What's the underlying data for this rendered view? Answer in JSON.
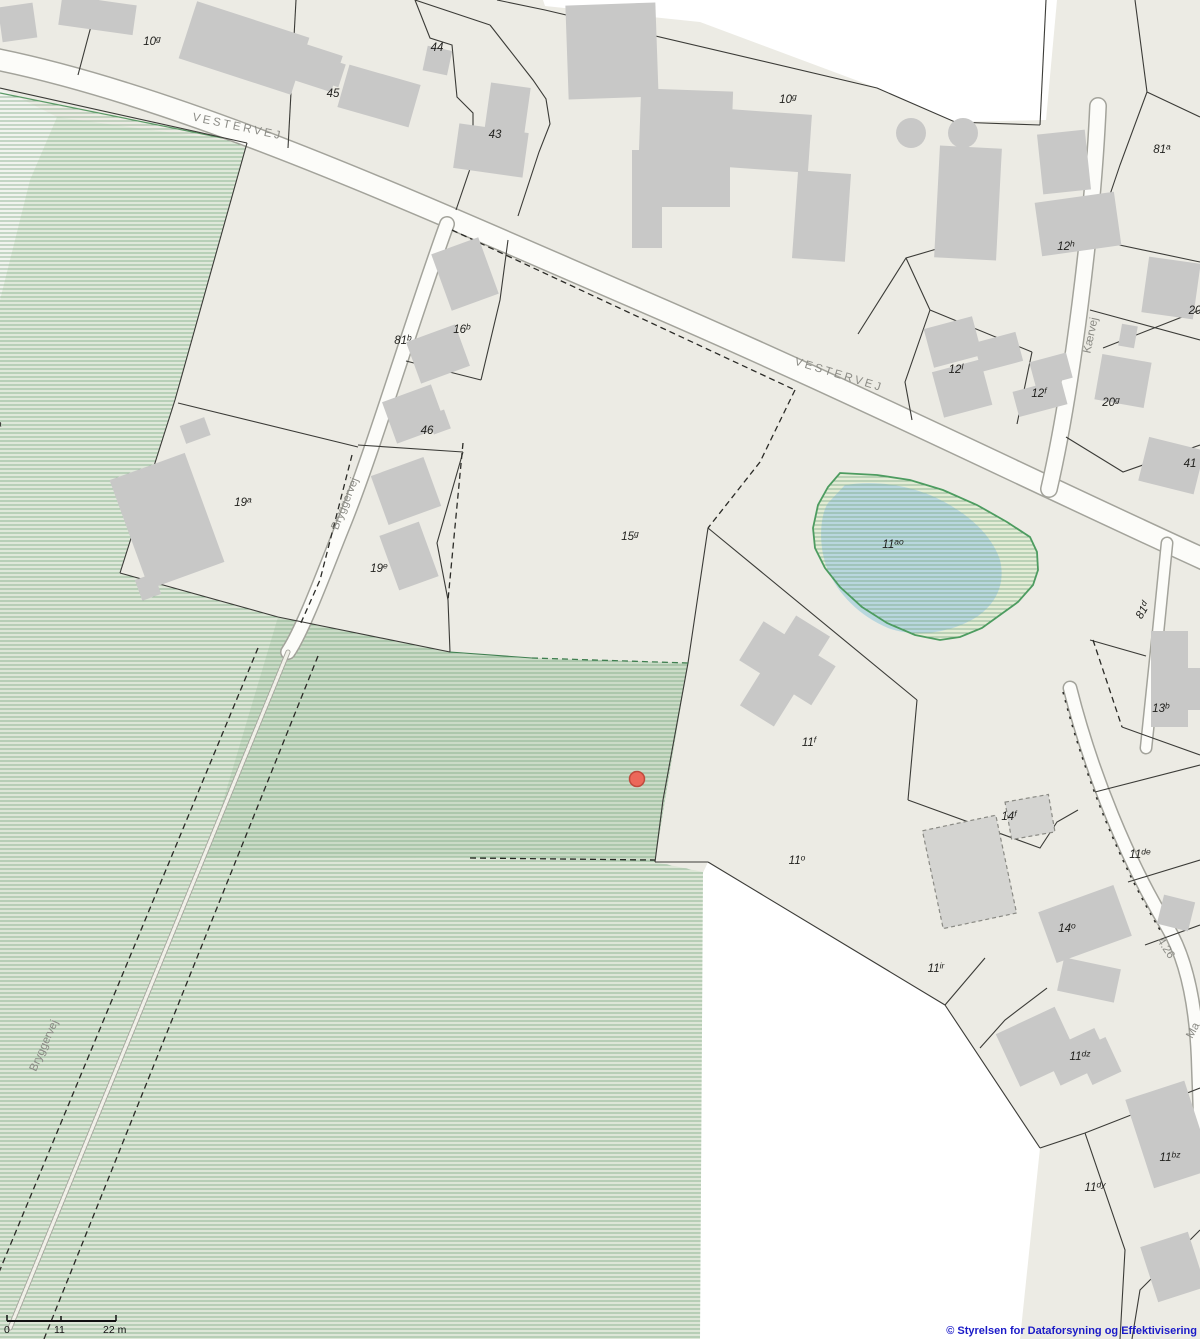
{
  "map": {
    "attribution": "© Styrelsen for Dataforsyning og Effektivisering",
    "scale_bar": {
      "start_label": "0",
      "mid_label": "11",
      "end_label": "22 m"
    },
    "marker": {
      "x": 637,
      "y": 779,
      "color": "#ec685a",
      "border": "#c04b3e"
    },
    "colors": {
      "land": "#ecebe4",
      "building": "#c8c8c7",
      "road_fill": "#fcfcf9",
      "road_casing": "#a3a39b",
      "parcel_line": "#3b3b37",
      "green_hatch": "#74a37c",
      "green_fill_light": "#dde6d7",
      "green_fill_dark": "#cbdbc7",
      "pond_blue": "#b9d7de",
      "pond_outline": "#4d9c60",
      "attribution_blue": "#1a1ac8",
      "marker_red": "#ec685a"
    },
    "road_labels": [
      {
        "text": "VESTERVEJ",
        "x": 237,
        "y": 130,
        "rot": 12,
        "ls": 2.8
      },
      {
        "text": "VESTERVEJ",
        "x": 838,
        "y": 378,
        "rot": 17,
        "ls": 2.8
      },
      {
        "text": "Bryggervej",
        "x": 348,
        "y": 505,
        "rot": -68
      },
      {
        "text": "Bryggervej",
        "x": 47,
        "y": 1047,
        "rot": -66
      },
      {
        "text": "Kærvej",
        "x": 1094,
        "y": 336,
        "rot": -78
      },
      {
        "text": "Ma",
        "x": 1196,
        "y": 1032,
        "rot": -62
      },
      {
        "text": "4.26",
        "x": 1163,
        "y": 950,
        "rot": 57,
        "fs": 10
      }
    ],
    "parcel_labels": [
      {
        "text": "10g",
        "x": 152,
        "y": 45
      },
      {
        "text": "44",
        "x": 437,
        "y": 51
      },
      {
        "text": "45",
        "x": 333,
        "y": 97
      },
      {
        "text": "43",
        "x": 495,
        "y": 138
      },
      {
        "text": "10g",
        "x": 788,
        "y": 103
      },
      {
        "text": "81a",
        "x": 1162,
        "y": 153
      },
      {
        "text": "12h",
        "x": 1066,
        "y": 250
      },
      {
        "text": "20",
        "x": 1195,
        "y": 314
      },
      {
        "text": "16b",
        "x": 462,
        "y": 333
      },
      {
        "text": "81b",
        "x": 403,
        "y": 344
      },
      {
        "text": "12l",
        "x": 956,
        "y": 373
      },
      {
        "text": "12f",
        "x": 1039,
        "y": 397
      },
      {
        "text": "20g",
        "x": 1111,
        "y": 406
      },
      {
        "text": "7a",
        "x": -4,
        "y": 430
      },
      {
        "text": "46",
        "x": 427,
        "y": 434
      },
      {
        "text": "41",
        "x": 1190,
        "y": 467
      },
      {
        "text": "19a",
        "x": 243,
        "y": 506
      },
      {
        "text": "15g",
        "x": 630,
        "y": 540
      },
      {
        "text": "11ao",
        "x": 893,
        "y": 548
      },
      {
        "text": "19e",
        "x": 379,
        "y": 572
      },
      {
        "text": "81d",
        "x": 1146,
        "y": 612,
        "rot": -60
      },
      {
        "text": "13b",
        "x": 1161,
        "y": 712
      },
      {
        "text": "11f",
        "x": 809,
        "y": 746
      },
      {
        "text": "14f",
        "x": 1009,
        "y": 820
      },
      {
        "text": "11de",
        "x": 1140,
        "y": 858
      },
      {
        "text": "11o",
        "x": 797,
        "y": 864
      },
      {
        "text": "14o",
        "x": 1067,
        "y": 932
      },
      {
        "text": "11ir",
        "x": 936,
        "y": 972
      },
      {
        "text": "11dz",
        "x": 1080,
        "y": 1060
      },
      {
        "text": "11bz",
        "x": 1170,
        "y": 1161
      },
      {
        "text": "11dy",
        "x": 1095,
        "y": 1191
      }
    ]
  }
}
